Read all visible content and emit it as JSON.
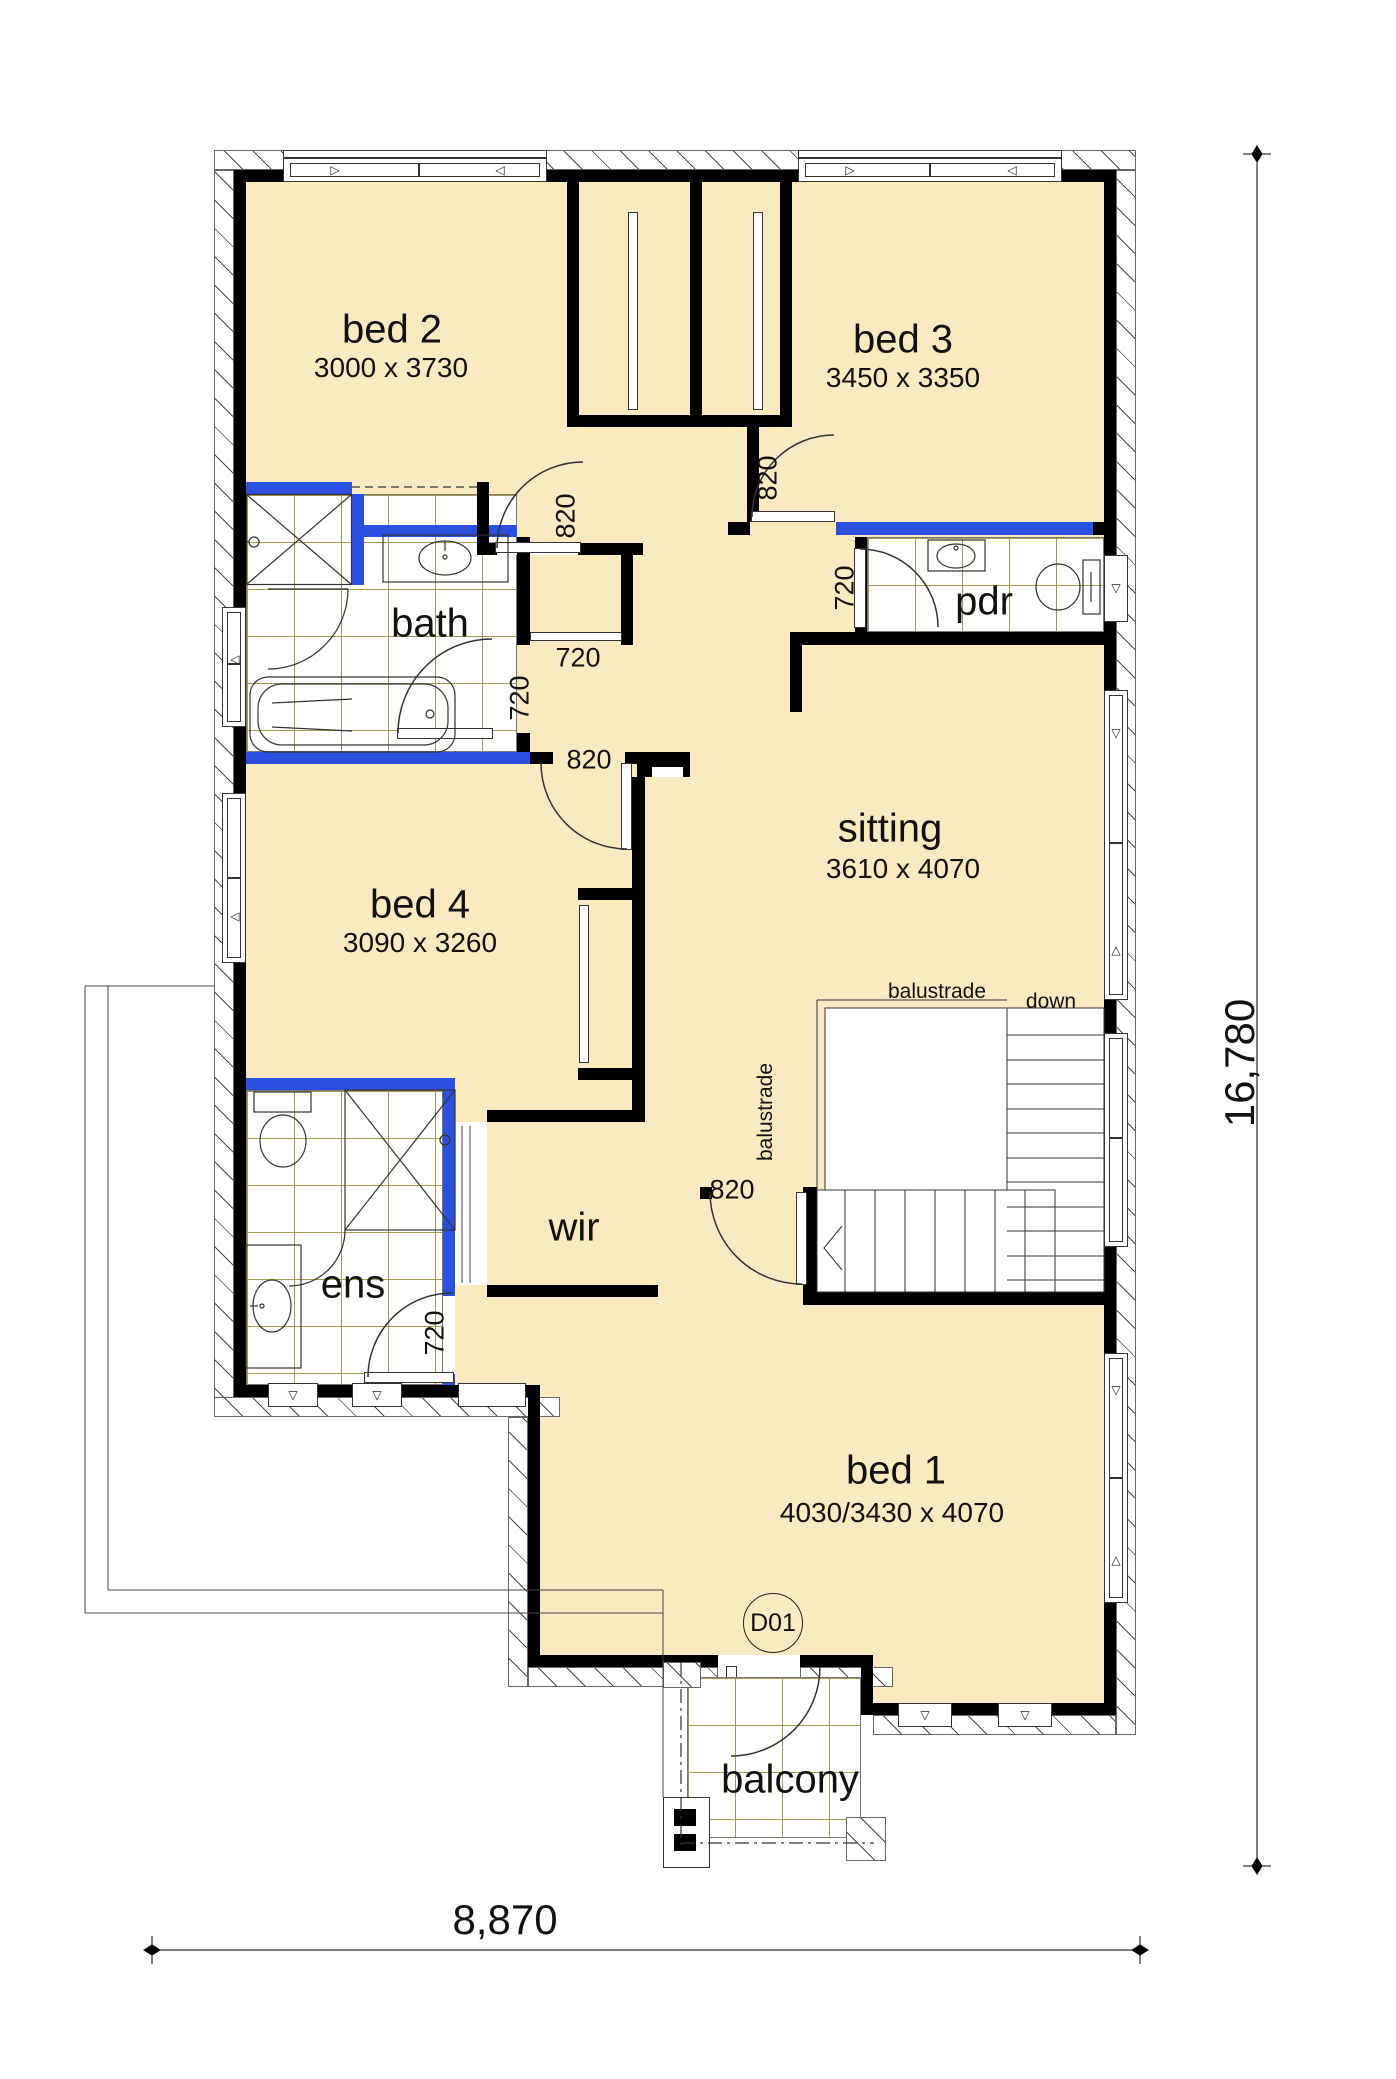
{
  "rooms": {
    "bed2": {
      "label": "bed 2",
      "dims": "3000 x 3730"
    },
    "bed3": {
      "label": "bed 3",
      "dims": "3450 x 3350"
    },
    "bed4": {
      "label": "bed 4",
      "dims": "3090 x 3260"
    },
    "bed1": {
      "label": "bed 1",
      "dims": "4030/3430 x 4070"
    },
    "sitting": {
      "label": "sitting",
      "dims": "3610 x 4070"
    },
    "bath": {
      "label": "bath"
    },
    "pdr": {
      "label": "pdr"
    },
    "ens": {
      "label": "ens"
    },
    "wir": {
      "label": "wir"
    },
    "balcony": {
      "label": "balcony"
    }
  },
  "doors": {
    "bed2": "820",
    "bed3": "820",
    "pdr": "720",
    "linen": "720",
    "bath": "720",
    "bed4": "820",
    "sitting": "820",
    "ens": "720",
    "balcony_tag": "D01"
  },
  "stairs": {
    "down": "down",
    "balustrade_top": "balustrade",
    "balustrade_side": "balustrade"
  },
  "dimensions": {
    "overall_width": "8,870",
    "overall_height": "16,780"
  },
  "icons": {
    "win_left": "◁",
    "win_right": "▷",
    "win_down": "▽",
    "win_up": "△"
  },
  "colors": {
    "room_fill": "#faeabf",
    "wet_wall": "#2b50e0",
    "wall": "#000000",
    "tile_line": "#a59a52"
  }
}
